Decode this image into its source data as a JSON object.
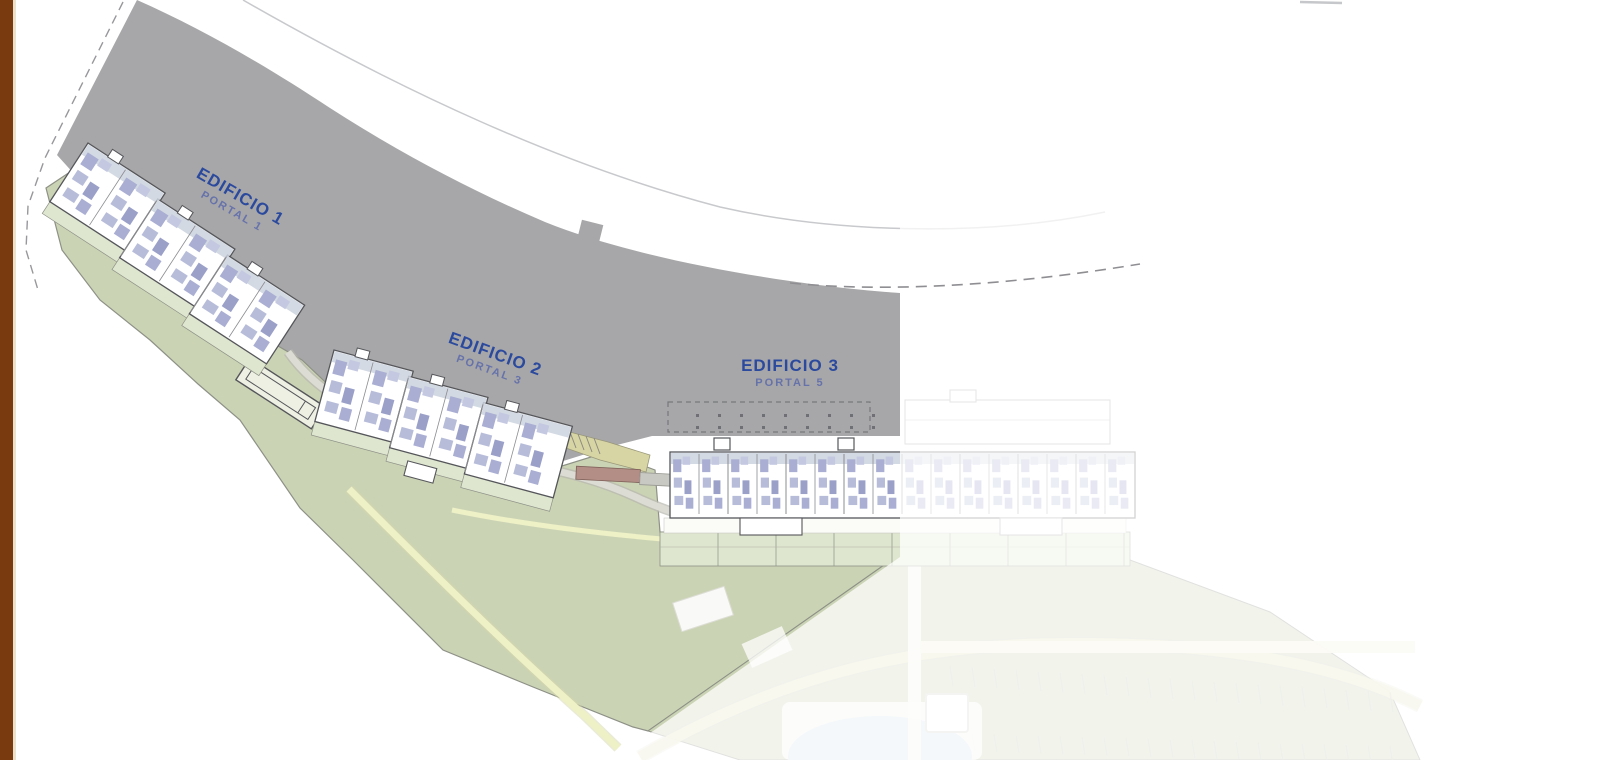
{
  "page": {
    "background_color": "#ffffff",
    "left_stripe_color": "#7a3a10"
  },
  "plan": {
    "type": "residential site plan",
    "buildings": [
      {
        "label": "EDIFICIO 1",
        "portal": "PORTAL 1"
      },
      {
        "label": "EDIFICIO 2",
        "portal": "PORTAL 3"
      },
      {
        "label": "EDIFICIO 3",
        "portal": "PORTAL 5"
      }
    ],
    "colors": {
      "terrain_gray": "#a7a7a9",
      "landscape_green": "#cbd3b5",
      "terrace_green": "#dfe6d0",
      "path_yellow": "#eef1c6",
      "label_blue": "#2b4a9e",
      "portal_blue": "#6672aa",
      "pool_blue": "#cfe3ef",
      "wall_pink": "#b28e86",
      "stair_tan": "#d8d5a4",
      "building_outline": "#55565a",
      "furniture_lavender": "#b7bcd9"
    }
  }
}
